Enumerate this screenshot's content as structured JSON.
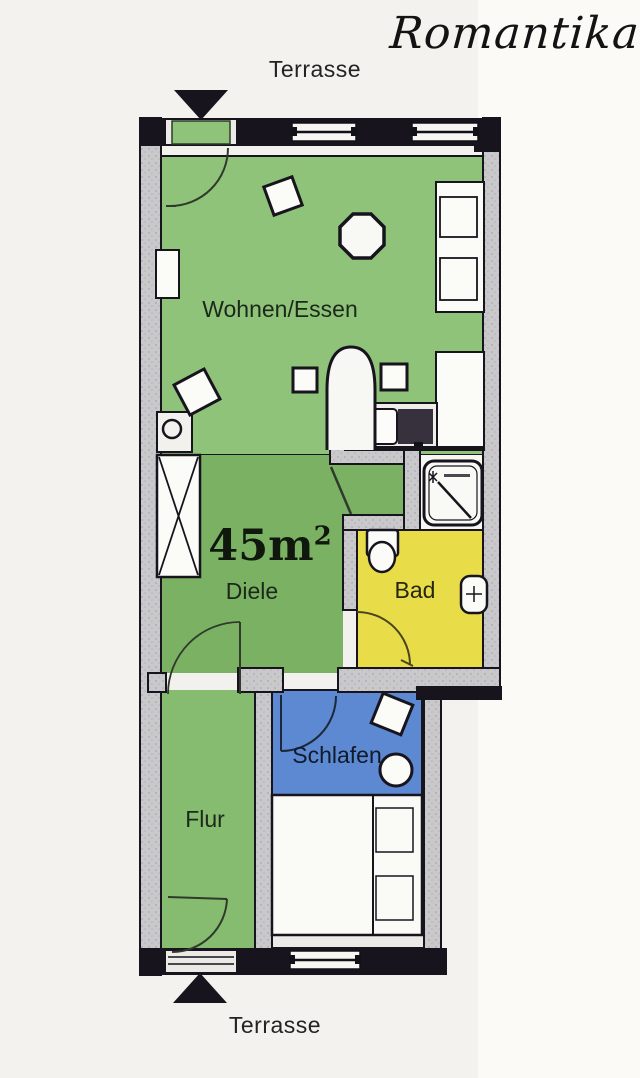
{
  "title": "Romantika",
  "area": {
    "base": "45m",
    "exponent": "2"
  },
  "labels": {
    "terrasse_top": "Terrasse",
    "terrasse_bottom": "Terrasse",
    "wohnen": "Wohnen/Essen",
    "diele": "Diele",
    "bad": "Bad",
    "schlafen": "Schlafen",
    "flur": "Flur"
  },
  "colors": {
    "living_green": "#8ec379",
    "hall_green": "#7ab163",
    "corridor_green": "#85bc6f",
    "bath_yellow": "#e8dc48",
    "bedroom_blue": "#5c89d2",
    "wall_gray": "#c9c8cb",
    "outline_black": "#17141d",
    "furniture_white": "#fbfbf8",
    "floor_white": "#f2f1ed"
  }
}
